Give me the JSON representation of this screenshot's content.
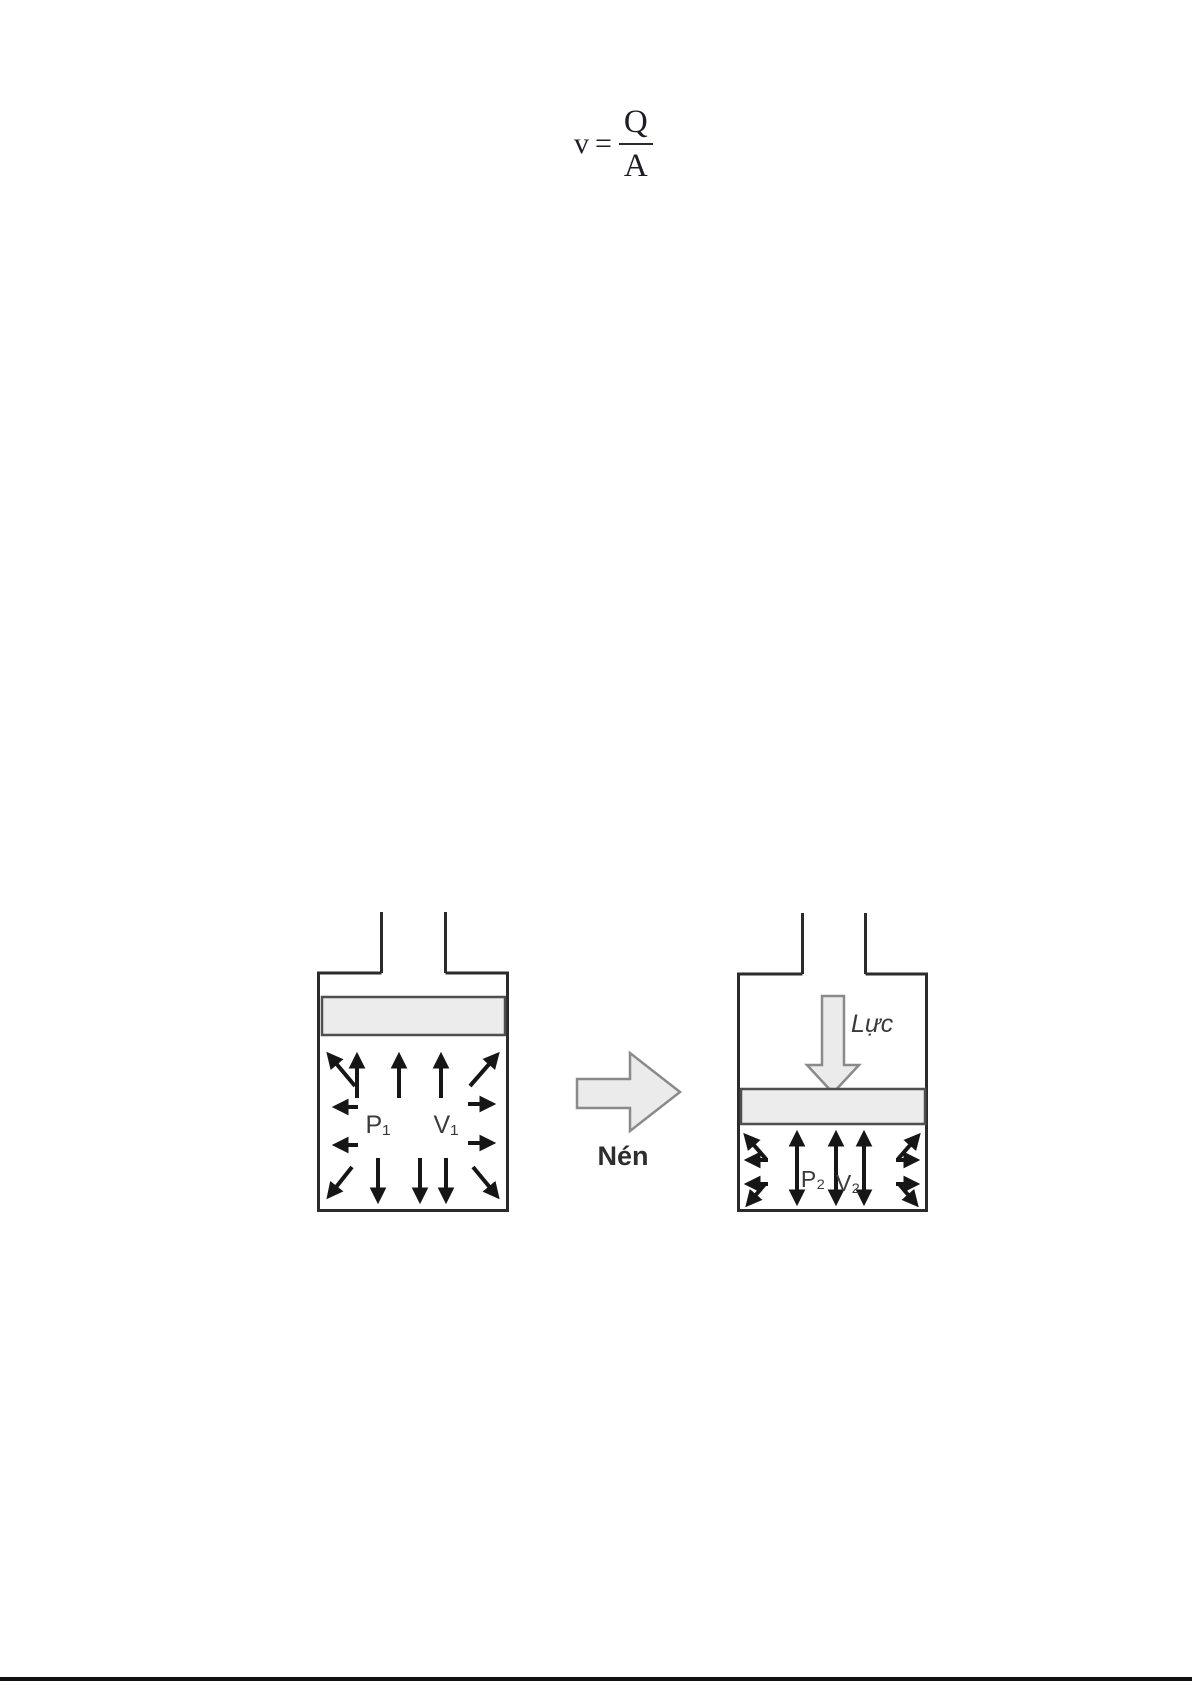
{
  "page": {
    "background": "#ffffff",
    "footer_bar_color": "#101010"
  },
  "formula": {
    "variable": "v",
    "equals": "=",
    "numerator": "Q",
    "denominator": "A"
  },
  "diagram": {
    "colors": {
      "outline": "#2b2b2b",
      "arrow": "#161616",
      "piston_fill": "#ececec",
      "piston_stroke": "#4f4f4f",
      "block_arrow_fill": "#ebebeb",
      "block_arrow_stroke": "#8a8a8a",
      "label": "#3a3a3a"
    },
    "cylinder_before": {
      "pressure_label": "P₁",
      "volume_label": "V₁"
    },
    "compress_arrow": {
      "label": "Nén"
    },
    "cylinder_after": {
      "force_label": "Lực",
      "pressure_label": "P₂",
      "volume_label": "V₂"
    }
  }
}
